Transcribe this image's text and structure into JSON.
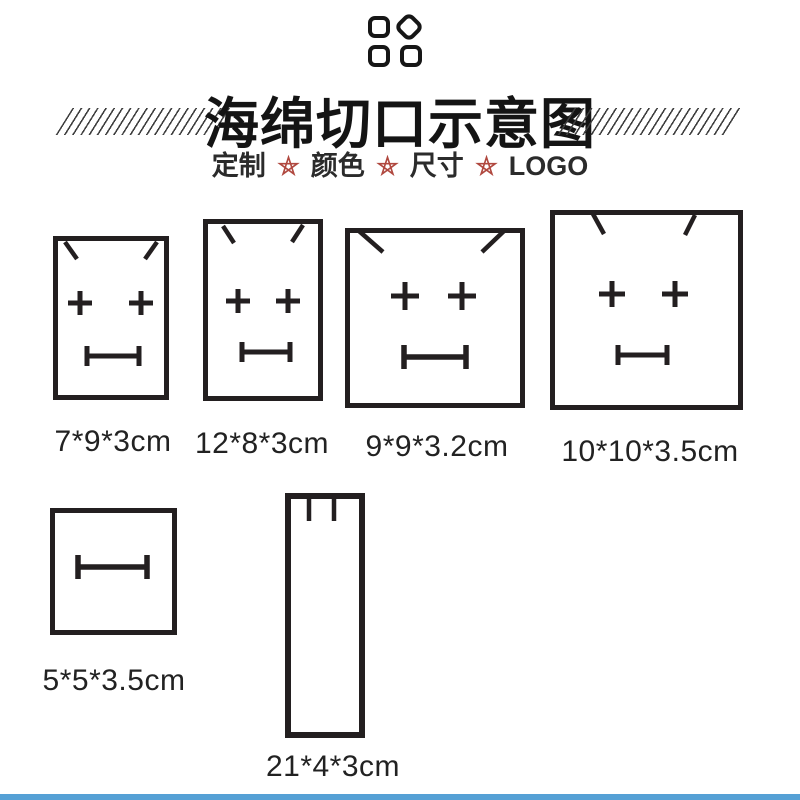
{
  "colors": {
    "line": "#231f20",
    "text": "#222222",
    "star": "#b0483f",
    "bottom_bar": "#55a0d5"
  },
  "header": {
    "logo_icon": "four-rounded-tiles-logo (top-right tile rotated as diamond)",
    "decoration": "diagonal-hatch-lines flanking title",
    "title": "海绵切口示意图",
    "subtitle": {
      "items": [
        "定制",
        "颜色",
        "尺寸",
        "LOGO"
      ],
      "separator_icon": "pentagram-star-icon"
    }
  },
  "diagrams": [
    {
      "label": "7*9*3cm",
      "marks": [
        "angled-corner-slits",
        "plus-cut",
        "plus-cut",
        "bar-slot"
      ]
    },
    {
      "label": "12*8*3cm",
      "marks": [
        "angled-corner-slits",
        "plus-cut",
        "plus-cut",
        "bar-slot"
      ]
    },
    {
      "label": "9*9*3.2cm",
      "marks": [
        "angled-corner-slits",
        "plus-cut",
        "plus-cut",
        "bar-slot"
      ]
    },
    {
      "label": "10*10*3.5cm",
      "marks": [
        "angled-corner-slits",
        "plus-cut",
        "plus-cut",
        "bar-slot"
      ]
    },
    {
      "label": "5*5*3.5cm",
      "marks": [
        "bar-slot"
      ]
    },
    {
      "label": "21*4*3cm",
      "marks": [
        "vertical-slit",
        "vertical-slit"
      ]
    }
  ]
}
